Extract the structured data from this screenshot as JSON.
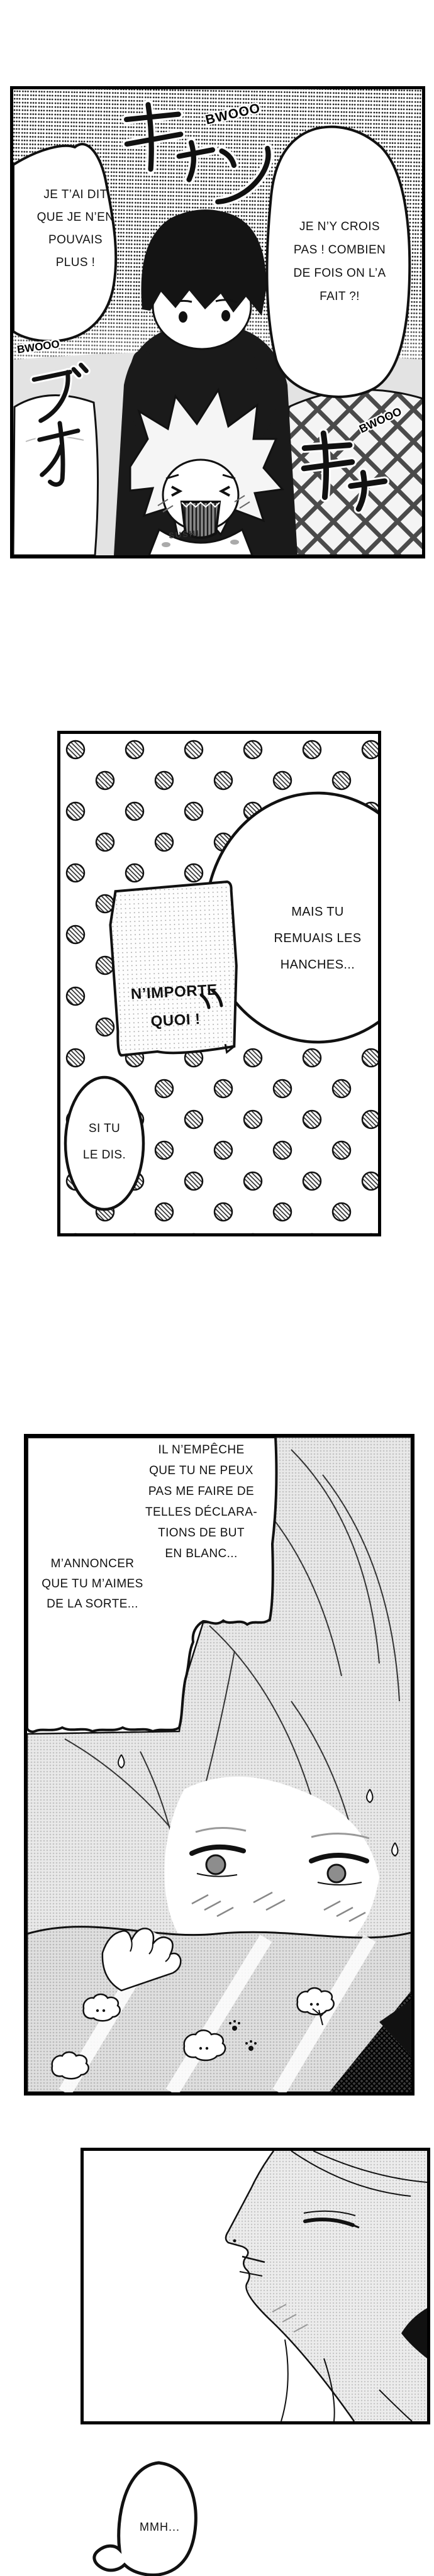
{
  "colors": {
    "ink": "#000000",
    "paper": "#ffffff",
    "tone_light": "#e9e9e9",
    "tone_mid": "#c9c9c9"
  },
  "panel1": {
    "bubble_left": {
      "lines": [
        "JE T’AI DIT",
        "QUE JE N’EN",
        "POUVAIS",
        "PLUS !"
      ]
    },
    "bubble_right": {
      "lines": [
        "JE N’Y CROIS",
        "PAS ! COMBIEN",
        "DE FOIS ON L’A",
        "FAIT ?!"
      ]
    },
    "sfx": {
      "top_kana": "キャン",
      "top_latin": "BWOOO",
      "left_latin": "BWOOO",
      "left_kana": "ブオ",
      "right_kana": "キャ",
      "right_latin": "BWOOO"
    },
    "shirt_text": "SUSHI"
  },
  "panel2": {
    "note": {
      "lines": [
        "N’IMPORTE",
        "QUOI !"
      ]
    },
    "bubble_main": {
      "lines": [
        "MAIS TU",
        "REMUAIS LES",
        "HANCHES..."
      ]
    },
    "bubble_small": {
      "lines": [
        "SI TU",
        "LE DIS."
      ]
    }
  },
  "panel3": {
    "bubble": {
      "lines": [
        "IL N’EMPÊCHE",
        "QUE TU NE PEUX",
        "PAS ME FAIRE DE",
        "TELLES DÉCLARA-",
        "TIONS DE BUT",
        "EN BLANC..."
      ]
    },
    "aside": {
      "lines": [
        "M’ANNONCER",
        "QUE TU M’AIMES",
        "DE LA SORTE..."
      ]
    }
  },
  "bubble_mmh": {
    "text": "MMH..."
  }
}
